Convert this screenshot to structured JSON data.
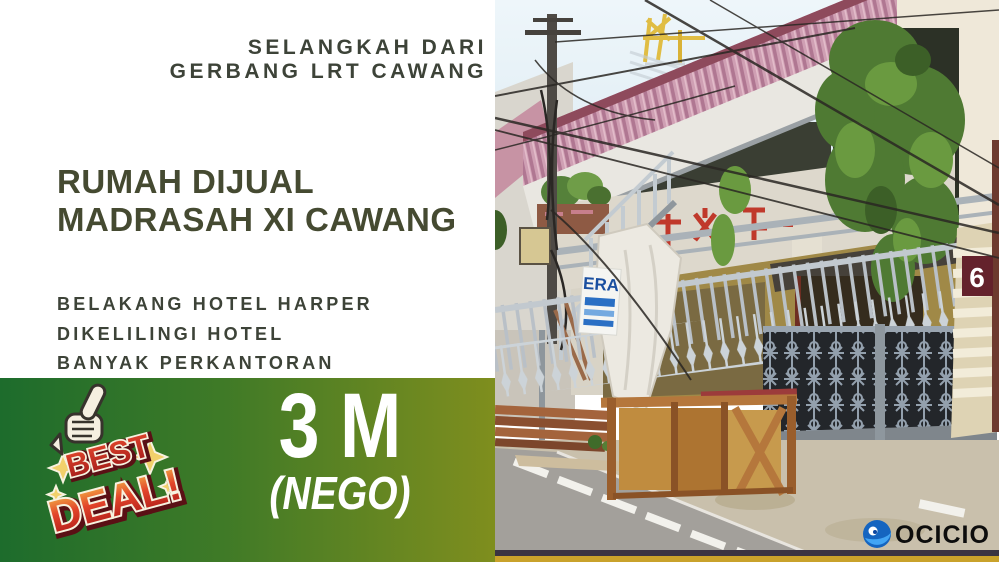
{
  "flyer": {
    "tagline": [
      "SELANGKAH DARI",
      "GERBANG LRT CAWANG"
    ],
    "title": [
      "RUMAH DIJUAL",
      "MADRASAH XI CAWANG"
    ],
    "features": [
      "BELAKANG HOTEL HARPER",
      "DIKELILINGI HOTEL",
      "BANYAK PERKANTORAN"
    ],
    "price": "3 M",
    "price_note": "(NEGO)",
    "badge": {
      "word1": "BEST",
      "word2": "DEAL!"
    },
    "colors": {
      "text_dark": "#3d4338",
      "band_green_left": "#1d6c2c",
      "band_green_right": "#7f8e1e",
      "badge_red": "#cf2a1e",
      "badge_star": "#f2d06b",
      "price_white": "#ffffff"
    }
  },
  "photo": {
    "house_number": "6",
    "agent_sign_text": "ERA",
    "watermark_text": "OCICIO",
    "house_number_sign_color": "#64222c",
    "watermark_blue": "#1565c0"
  }
}
